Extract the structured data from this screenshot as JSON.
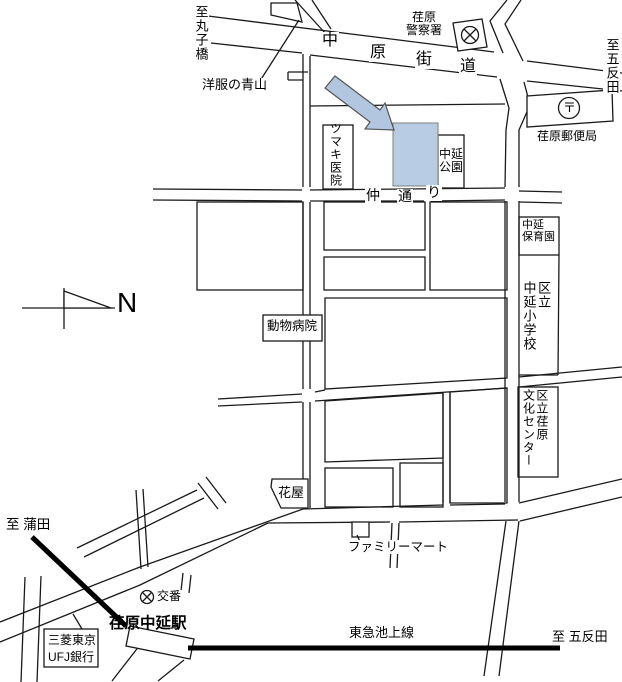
{
  "colors": {
    "road_line": "#1a1a1a",
    "building_fill": "#b8cce4",
    "building_stroke": "#7f7f7f",
    "arrow_fill": "#b3c6e0",
    "railway": "#000000"
  },
  "labels": {
    "to_marukobashi": "至丸子橋",
    "yofuku_no_aoyama": "洋服の青山",
    "nakahara_kaido_chars": [
      "中",
      "原",
      "街",
      "道"
    ],
    "ebara_police_line1": "荏原",
    "ebara_police_line2": "警察署",
    "to_gotanda_top": "至五反田",
    "ebara_post_office": "荏原郵便局",
    "postal_mark": "〒",
    "tsumaki_clinic": "ツマキ医院",
    "nakanobu_park_line1": "中延",
    "nakanobu_park_line2": "公園",
    "naka_dori_chars": [
      "仲",
      "通",
      "り"
    ],
    "nakanobu_hoikuen_line1": "中延",
    "nakanobu_hoikuen_line2": "保育園",
    "elementary_col1": "区立",
    "elementary_col2": "中延小学校",
    "animal_hospital": "動物病院",
    "compass_n": "N",
    "bunka_center_col1": "区立荏原",
    "bunka_center_col2": "文化センター",
    "hanaya": "花屋",
    "familymart": "ファミリーマート",
    "to_kamata": "至 蒲田",
    "koban": "交番",
    "ebara_nakanobu_station": "荏原中延駅",
    "bank_line1": "三菱東京",
    "bank_line2": "UFJ銀行",
    "tokyu_ikegami_line": "東急池上線",
    "to_gotanda_bottom": "至 五反田"
  }
}
